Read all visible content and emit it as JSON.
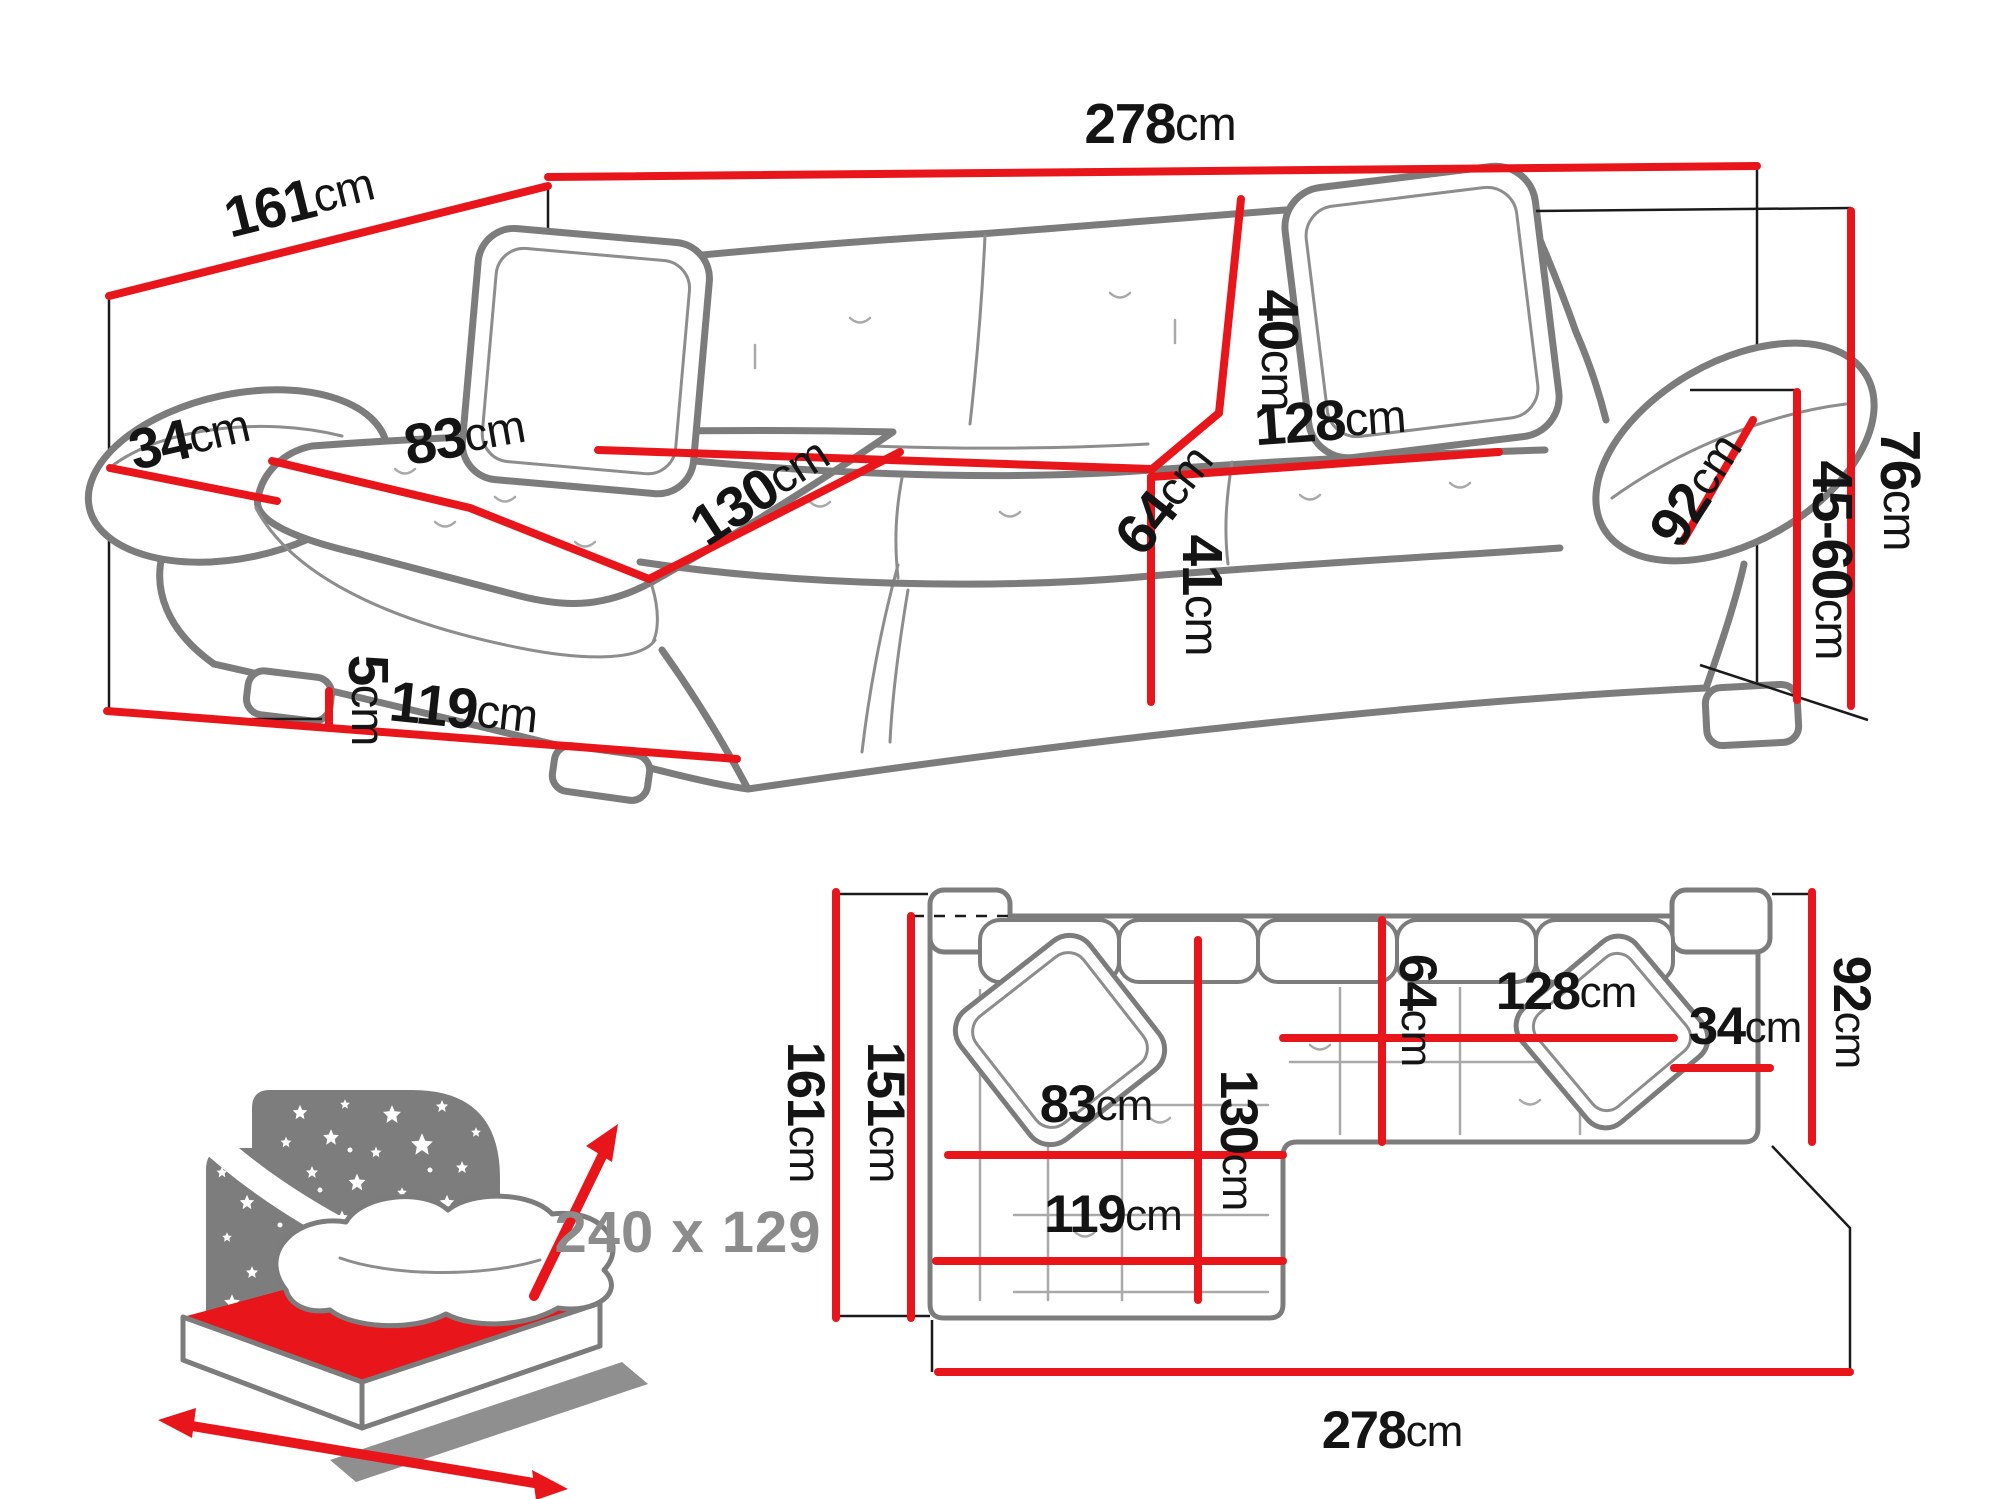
{
  "colors": {
    "dimension_red": "#e8151a",
    "outline_gray": "#7c7c7c",
    "seam_gray": "#a9a9a9",
    "guide_black": "#1a1a1a",
    "icon_gray": "#7d7d7d",
    "sleeping_label_gray": "#8c8c8c",
    "text_black": "#141414"
  },
  "perspective_view": {
    "dims": {
      "depth_total": {
        "v": "161",
        "u": "cm"
      },
      "width_total": {
        "v": "278",
        "u": "cm"
      },
      "armrest_width": {
        "v": "34",
        "u": "cm"
      },
      "chaise_seat_width": {
        "v": "83",
        "u": "cm"
      },
      "chaise_length": {
        "v": "130",
        "u": "cm"
      },
      "backrest_height": {
        "v": "40",
        "u": "cm"
      },
      "seat_depth": {
        "v": "64",
        "u": "cm"
      },
      "seat_width": {
        "v": "128",
        "u": "cm"
      },
      "armrest_depth": {
        "v": "92",
        "u": "cm"
      },
      "seat_front_height": {
        "v": "41",
        "u": "cm"
      },
      "leg_height": {
        "v": "5",
        "u": "cm"
      },
      "chaise_total_width": {
        "v": "119",
        "u": "cm"
      },
      "total_height": {
        "v": "76",
        "u": "cm"
      },
      "seat_height_range": {
        "v": "45-60",
        "u": "cm"
      }
    }
  },
  "plan_view": {
    "dims": {
      "depth_total": {
        "v": "161",
        "u": "cm"
      },
      "depth_inner": {
        "v": "151",
        "u": "cm"
      },
      "chaise_length": {
        "v": "130",
        "u": "cm"
      },
      "seat_depth": {
        "v": "64",
        "u": "cm"
      },
      "seat_width": {
        "v": "128",
        "u": "cm"
      },
      "armrest_width": {
        "v": "34",
        "u": "cm"
      },
      "armrest_depth": {
        "v": "92",
        "u": "cm"
      },
      "chaise_seat_width": {
        "v": "83",
        "u": "cm"
      },
      "chaise_total_width": {
        "v": "119",
        "u": "cm"
      },
      "width_total": {
        "v": "278",
        "u": "cm"
      }
    }
  },
  "sleeping_area": {
    "label": "240 x 129"
  }
}
